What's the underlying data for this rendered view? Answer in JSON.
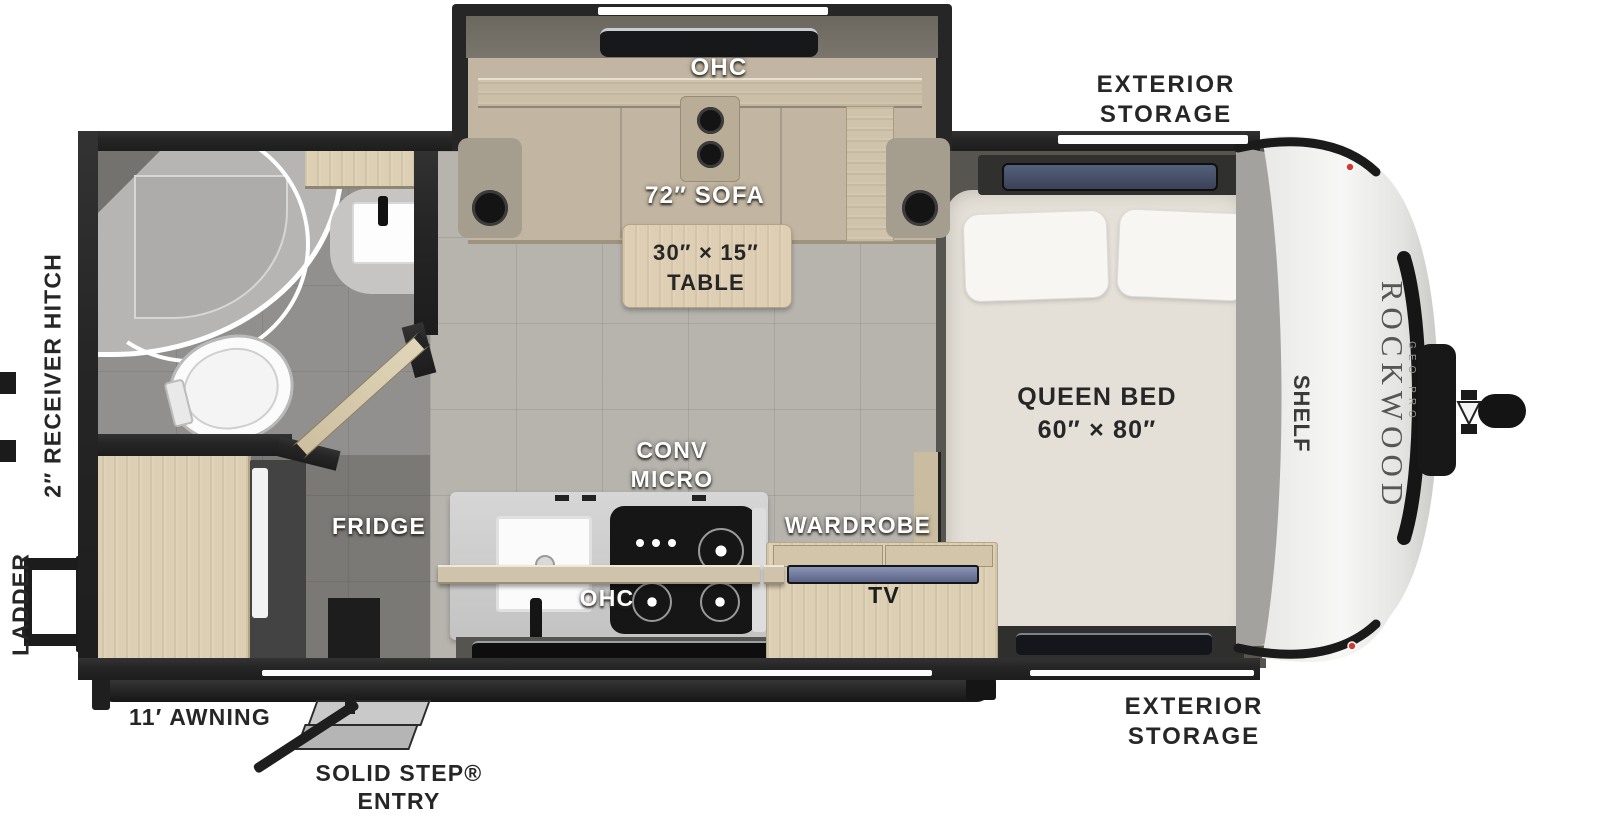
{
  "brand": {
    "name": "ROCKWOOD",
    "sub": "GEO PRO"
  },
  "labels": {
    "ohc_slide": "OHC",
    "sofa": "72″ SOFA",
    "table_size": "30″ × 15″",
    "table_word": "TABLE",
    "bed_name": "QUEEN BED",
    "bed_size": "60″ × 80″",
    "shelf": "SHELF",
    "wardrobe": "WARDROBE",
    "tv": "TV",
    "conv_line1": "CONV",
    "conv_line2": "MICRO",
    "ohc_kitchen": "OHC",
    "fridge": "FRIDGE",
    "storage_line1": "EXTERIOR",
    "storage_line2": "STORAGE",
    "receiver_hitch": "2″ RECEIVER HITCH",
    "ladder": "LADDER",
    "awning": "11′ AWNING",
    "entry_line1": "SOLID STEP®",
    "entry_line2": "ENTRY"
  },
  "colors": {
    "wall": "#262626",
    "wood": "#dccfb4",
    "wood2": "#c9bca0",
    "sofa": "#c2b6a2",
    "floor": "#b7b4ae",
    "floorDark": "#57554f",
    "bathFloor": "#91908e",
    "rearFloor": "#7b7975",
    "mattress": "#e4e0d7",
    "counter": "#cccccc",
    "stove": "#161616",
    "screen": "#7f89ab",
    "labelDark": "#262626"
  }
}
